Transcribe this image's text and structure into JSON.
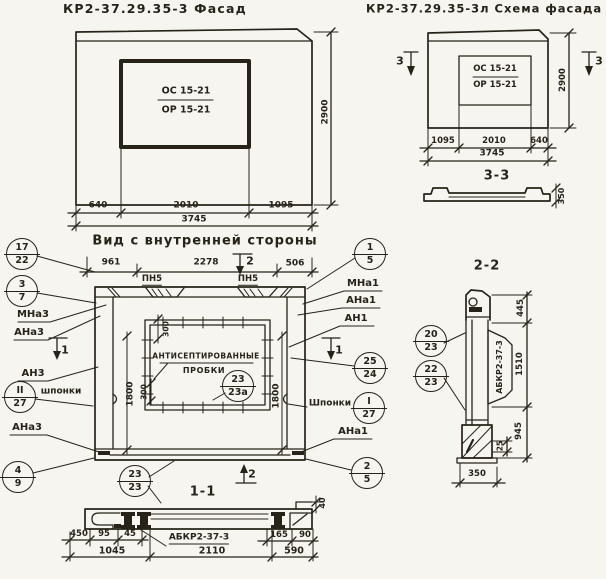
{
  "palette": {
    "paper": "#f6f5ef",
    "ink": "#272319"
  },
  "facade": {
    "title": "КР2-37.29.35-3 Фасад",
    "window_top": "ОС 15-21",
    "window_bottom": "ОР 15-21",
    "dim_height": "2900",
    "dim_b": [
      "640",
      "2010",
      "1095"
    ],
    "dim_total": "3745"
  },
  "scheme": {
    "title": "КР2-37.29.35-3л Схема фасада",
    "window_top": "ОС 15-21",
    "window_bottom": "ОР 15-21",
    "mark_left": "3",
    "mark_right": "3",
    "dim_height": "2900",
    "dim_b": [
      "1095",
      "2010",
      "640"
    ],
    "dim_total": "3745",
    "section_label": "3-3",
    "profile_dim": "350"
  },
  "view": {
    "title": "Вид с внутренней стороны",
    "dim_t": [
      "961",
      "2278",
      "506"
    ],
    "loop_label_1": "ПН5",
    "loop_label_2": "ПН5",
    "mark_2_top": "2",
    "mark_2_bottom": "2",
    "mark_1_left": "1",
    "mark_1_right": "1",
    "labels_left": {
      "mna3": "МНа3",
      "ana3": "АНа3",
      "an3": "АН3",
      "shponki": "шпонки",
      "ana3b": "АНа3"
    },
    "labels_right": {
      "mna1": "МНа1",
      "ana1": "АНа1",
      "an1": "АН1",
      "shponki": "Шпонки",
      "ana1b": "АНа1"
    },
    "plugs_line1": "АНТИСЕПТИРОВАННЫЕ",
    "plugs_line2": "ПРОБКИ",
    "dim_left": "1800",
    "dim_right": "1800",
    "dim_300_top": "300",
    "dim_300_bottom": "300",
    "section_label": "1-1",
    "callouts": {
      "c17": {
        "top": "17",
        "bot": "22"
      },
      "c3": {
        "top": "3",
        "bot": "7"
      },
      "c11": {
        "top": "II",
        "bot": "27"
      },
      "c4": {
        "top": "4",
        "bot": "9"
      },
      "c1": {
        "top": "1",
        "bot": "5"
      },
      "c25": {
        "top": "25",
        "bot": "24"
      },
      "cI": {
        "top": "I",
        "bot": "27"
      },
      "c2": {
        "top": "2",
        "bot": "5"
      },
      "c23a": {
        "top": "23",
        "bot": "23а"
      },
      "c23": {
        "top": "23",
        "bot": "23"
      }
    }
  },
  "sec11": {
    "dims_left": [
      "450",
      "95",
      "45"
    ],
    "dims_right": [
      "165",
      "90"
    ],
    "dims_total": [
      "1045",
      "2110",
      "590"
    ],
    "dim_40": "40",
    "part_label": "АБКР2-37-3"
  },
  "sec22": {
    "title": "2-2",
    "part_label": "АБКР2-37-3",
    "dim_top": "445",
    "dim_mid": "1510",
    "dim_bottom": "945",
    "dim_25": "25",
    "dim_350": "350",
    "callouts": {
      "c20": {
        "top": "20",
        "bot": "23"
      },
      "c22": {
        "top": "22",
        "bot": "23"
      }
    }
  }
}
